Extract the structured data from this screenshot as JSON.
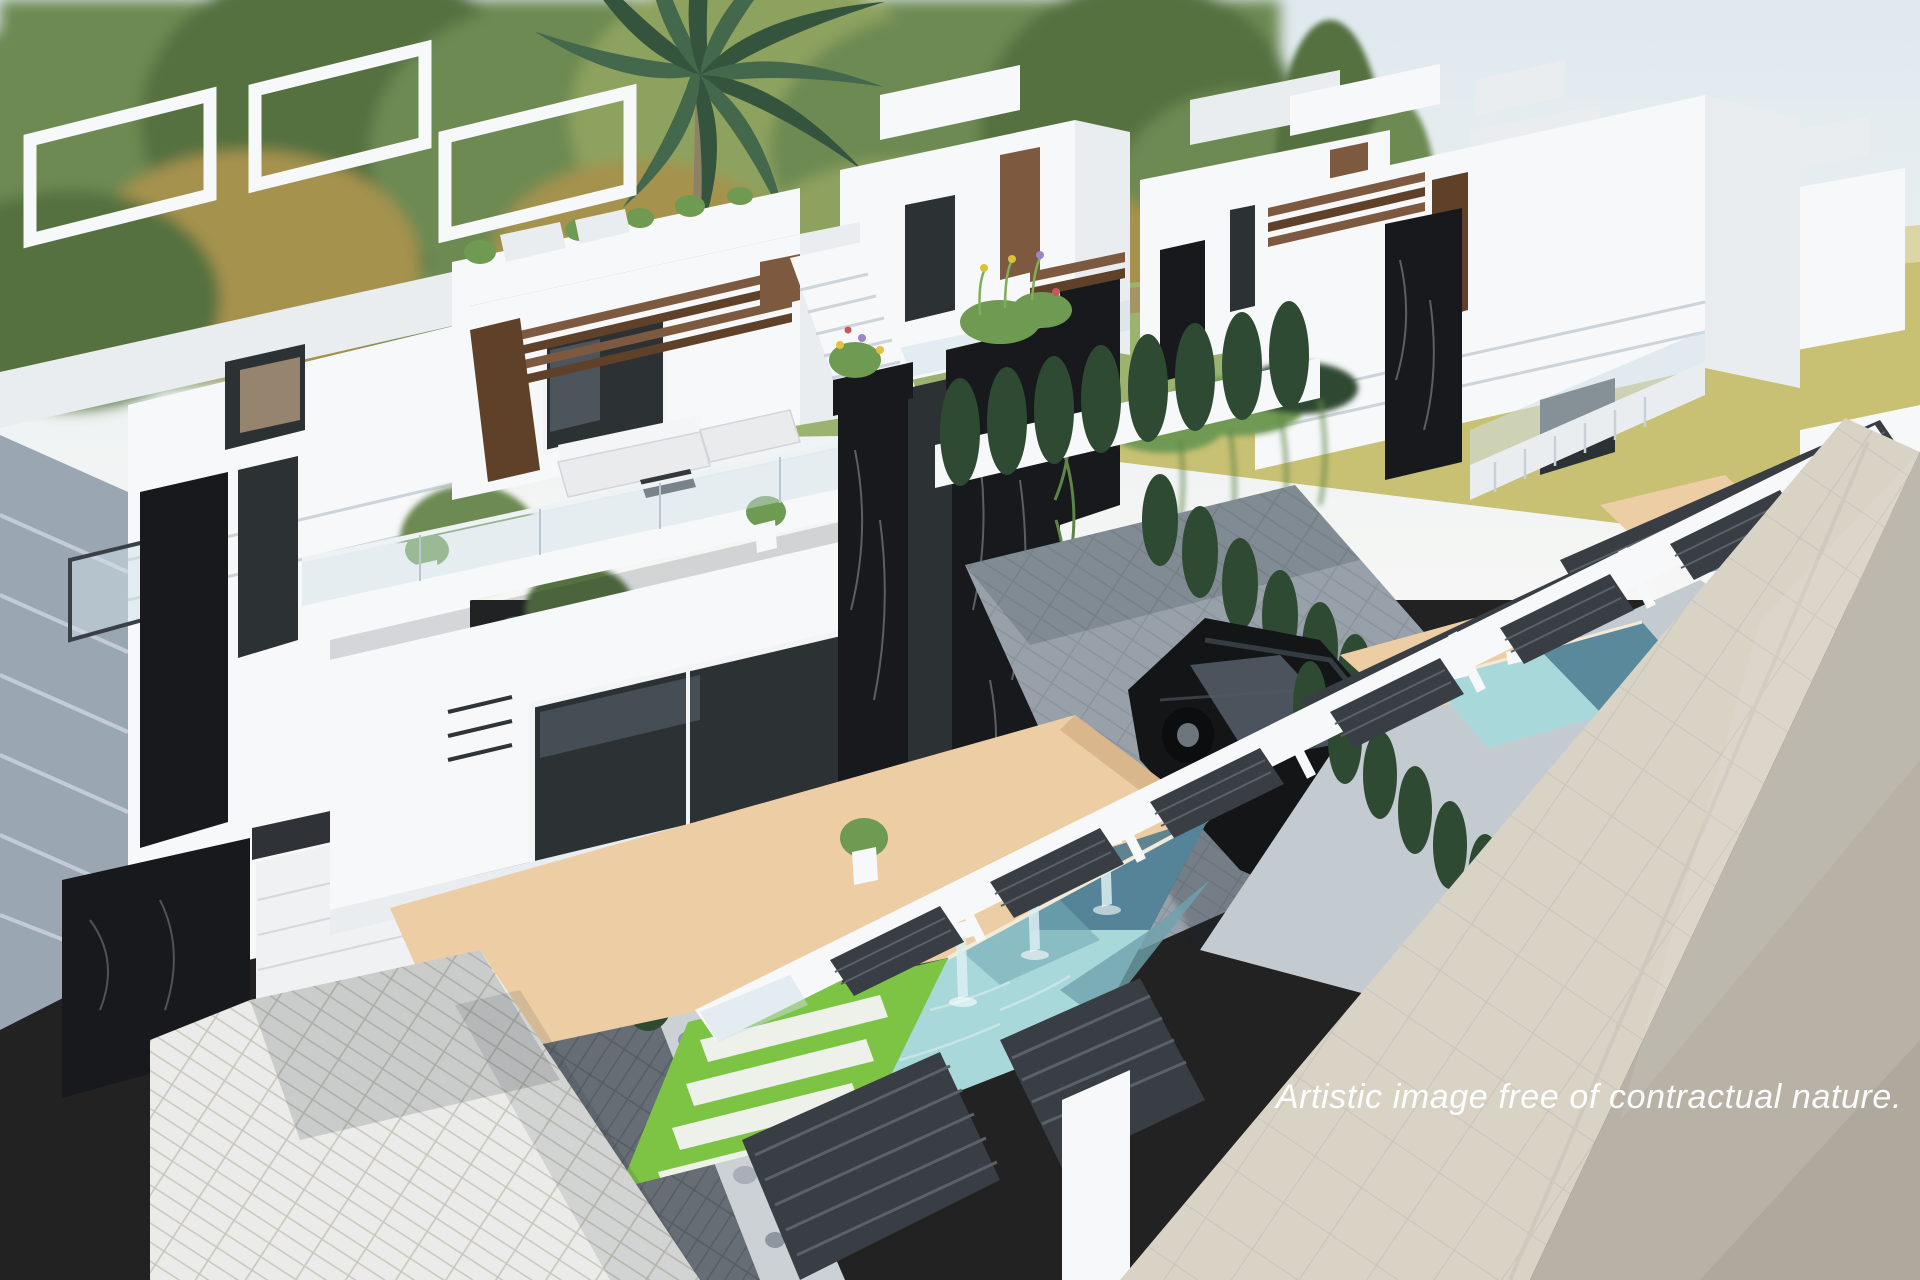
{
  "caption": {
    "text": "Artistic image free of contractual nature."
  },
  "scene": {
    "type": "3d-architectural-render",
    "subject": "Aerial render of a row of modern white villas, each with a rooftop terrace, wood pergola, black marble pillars, private turquoise pool with waterfall spouts, beige sun deck, lawn with paver strips, cypress hedges, a parked black car, dark slat fencing, tiled sidewalk and street in the foreground",
    "elements": [
      "sky",
      "tree line",
      "palm tree",
      "distant yellow field",
      "rows of white villas",
      "rooftop terrace furniture",
      "wood pergola slats",
      "glass balustrades",
      "black marble pillars with flower planters",
      "outdoor sofa set on terrace",
      "large glass sliding door",
      "staircase",
      "cypress hedges",
      "black car on paver driveway",
      "courtyard pavers",
      "turquoise pool with three waterfall spouts",
      "beige sun deck",
      "lawn with white paver strips",
      "gravel and pebble beds",
      "white herringbone driveway and garage",
      "gray tiled roof",
      "dark slat perimeter fence with white pillars",
      "neighbour pools",
      "tiled sidewalk",
      "asphalt road",
      "watermark caption"
    ]
  },
  "palette": {
    "sky-top": "#dfe9ee",
    "sky-bottom": "#f6f7f5",
    "field": "#c8c073",
    "grass-bg": "#9cb36f",
    "dirt": "#a98a63",
    "tree-mid": "#6d8a52",
    "tree-dark": "#55713f",
    "tree-light": "#8ea25e",
    "tree-yellow": "#a5924d",
    "palm": "#44684c",
    "palm-dark": "#35543d",
    "trunk": "#8d8168",
    "wall-white": "#f7f8f9",
    "wall-light": "#e9edf0",
    "wall-shade": "#ccd4da",
    "wall-dark": "#b4bec6",
    "glass-dark": "#2c3134",
    "glass-pane": "#cfe0e7",
    "wood": "#7d5a3f",
    "wood-dark": "#5e4128",
    "marble": "#17191c",
    "hedge": "#2f4a33",
    "plant": "#6f9a52",
    "pool-light": "#a9d8da",
    "pool-mid": "#6fa3ae",
    "pool-dark": "#47768c",
    "deck": "#eccda4",
    "deck-shade": "#d9b68c",
    "lawn": "#7dc344",
    "paver-bar": "#eef0ea",
    "gravel": "#d3d7d9",
    "pebble": "#a7b0b8",
    "pebble-dark": "#8e979f",
    "drive": "#ebecea",
    "joint": "#c9c6bc",
    "paver-dark": "#666d74",
    "paver-gray": "#98a1a9",
    "patio": "#c3cbd1",
    "fence-dark": "#383e44",
    "fence-line": "#5a6168",
    "sidewalk": "#d9d3c6",
    "road": "#b8b2a6",
    "car": "#131517",
    "car-glass": "#4b545c",
    "car-rim": "#6d757d",
    "shadow": "#1d2733",
    "sofa": "#e9ebed",
    "caption-color": "#ffffff"
  }
}
